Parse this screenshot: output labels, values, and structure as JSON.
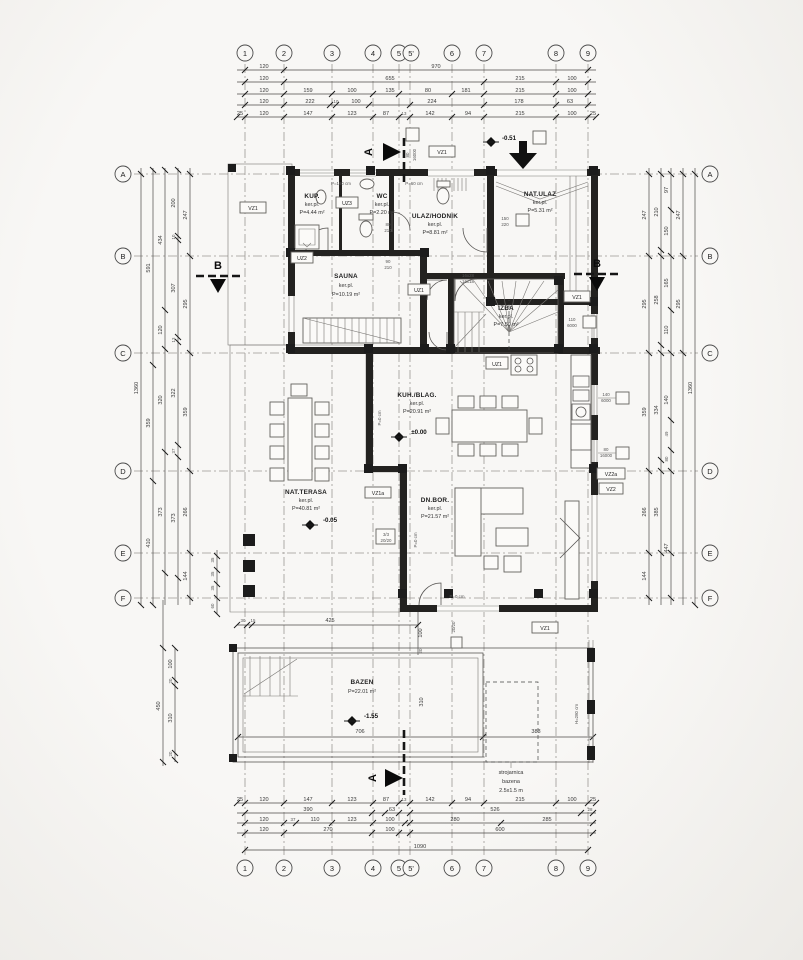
{
  "drawing": {
    "grid_cols": [
      "1",
      "2",
      "3",
      "4",
      "5",
      "5'",
      "6",
      "7",
      "8",
      "9"
    ],
    "grid_rows": [
      "A",
      "B",
      "C",
      "D",
      "E",
      "F"
    ],
    "section_a": "A",
    "section_b": "B"
  },
  "dims": {
    "top": {
      "r1": [
        "120",
        "970"
      ],
      "r2": [
        "120",
        "655",
        "215",
        "100"
      ],
      "r3": [
        "120",
        "159",
        "100",
        "135",
        "80",
        "181",
        "215",
        "100"
      ],
      "r4": [
        "120",
        "222",
        "10",
        "100",
        "224",
        "178",
        "63"
      ],
      "r5": [
        "25",
        "120",
        "147",
        "123",
        "87",
        "13",
        "142",
        "94",
        "215",
        "100",
        "25"
      ]
    },
    "bottom": {
      "r1": [
        "25",
        "120",
        "147",
        "123",
        "87",
        "13",
        "142",
        "94",
        "215",
        "100",
        "25"
      ],
      "r2": [
        "390",
        "63",
        "526",
        "28"
      ],
      "r3": [
        "120",
        "37",
        "110",
        "123",
        "100",
        "280",
        "285"
      ],
      "r4": [
        "120",
        "270",
        "100",
        "600"
      ],
      "r5": [
        "1090"
      ]
    },
    "left": {
      "c1": [
        "1360"
      ],
      "c2": [
        "591",
        "359",
        "410"
      ],
      "c3": [
        "434",
        "120",
        "320",
        "373"
      ],
      "c4": [
        "200",
        "10",
        "307",
        "13",
        "322",
        "37",
        "373"
      ],
      "c5": [
        "247",
        "295",
        "359",
        "266",
        "144"
      ],
      "steps": [
        "35",
        "35",
        "35",
        "60"
      ],
      "pool": [
        "450",
        "100",
        "20",
        "310",
        "20"
      ]
    },
    "right": {
      "c1": [
        "247",
        "295",
        "359",
        "266",
        "144"
      ],
      "c2": [
        "210",
        "258",
        "334",
        "385"
      ],
      "c3": [
        "97",
        "150",
        "165",
        "110",
        "140",
        "49",
        "80",
        "447"
      ],
      "c4": [
        "247",
        "295"
      ],
      "c5": [
        "1360"
      ],
      "fence": "H=280 cm"
    },
    "inner": {
      "pool_w": "706",
      "pool_h": "310",
      "pool_r": "383",
      "terr": [
        "30",
        "15",
        "425",
        "100",
        "20"
      ]
    }
  },
  "rooms": {
    "kup": {
      "n": "KUP.",
      "f": "ker.pl.",
      "a": "P=4.44 m²"
    },
    "wc": {
      "n": "WC",
      "f": "ker.pl.",
      "a": "P=2.20 m²"
    },
    "ulaz": {
      "n": "ULAZ/HODNIK",
      "f": "ker.pl.",
      "a": "P=8.81 m²"
    },
    "natulaz": {
      "n": "NAT.ULAZ",
      "f": "ker.pl.",
      "a": "P=5.31 m²"
    },
    "sauna": {
      "n": "SAUNA",
      "f": "ker.pl.",
      "a": "P=10.19 m²"
    },
    "izba": {
      "n": "IZBA",
      "f": "ker.pl.",
      "a": "P=7.50 m²"
    },
    "kuh": {
      "n": "KUH./BLAG.",
      "f": "ker.pl.",
      "a": "P=20.91 m²"
    },
    "dnbor": {
      "n": "DN.BOR.",
      "f": "ker.pl.",
      "a": "P=21.57 m²"
    },
    "terasa": {
      "n": "NAT.TERASA",
      "f": "ker.pl.",
      "a": "P=40.81 m²"
    },
    "bazen": {
      "n": "BAZEN",
      "a": "P=22.01 m²"
    }
  },
  "levels": {
    "entry": "-0.51",
    "zero": "±0.00",
    "terrace": "-0.05",
    "pool": "-1.55"
  },
  "tags": {
    "vz1": "VZ1",
    "vz1a": "VZ1a",
    "vz2": "VZ2",
    "vz2a": "VZ2a",
    "uz1": "UZ1",
    "uz2": "UZ2",
    "uz3": "UZ3"
  },
  "specs": {
    "s80_160": [
      "80",
      "16000"
    ],
    "s110_60": [
      "110",
      "6000"
    ],
    "s140_60": [
      "140",
      "6000"
    ],
    "s150_220": [
      "150",
      "220"
    ],
    "d80": [
      "80",
      "210"
    ],
    "d90": [
      "90",
      "210"
    ],
    "stair": [
      "16x28",
      "16x18"
    ],
    "col": [
      "3/3",
      "20/20"
    ],
    "col2": "20/20",
    "p180": "P=180 cm",
    "p60": "P=60 cm",
    "p0": "P=0 cm"
  },
  "notes": {
    "m1": "strojarnica",
    "m2": "bazena",
    "m3": "2.5x1.5 m"
  }
}
